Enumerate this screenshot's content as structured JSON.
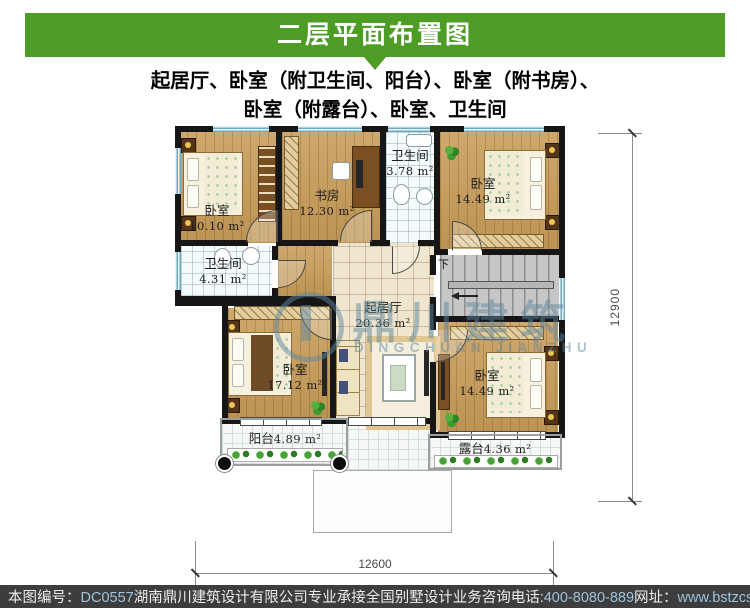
{
  "header": {
    "title": "二层平面布置图"
  },
  "subtitle": {
    "line1": "起居厅、卧室（附卫生间、阳台）、卧室（附书房）、",
    "line2": "卧室（附露台）、卧室、卫生间"
  },
  "rooms": [
    {
      "name": "卧室",
      "area": "10.10 m²"
    },
    {
      "name": "书房",
      "area": "12.30 m²"
    },
    {
      "name": "卫生间",
      "area": "3.78 m²"
    },
    {
      "name": "卧室",
      "area": "14.49 m²"
    },
    {
      "name": "卫生间",
      "area": "4.31 m²"
    },
    {
      "name": "起居厅",
      "area": "20.36 m²"
    },
    {
      "name": "卧室",
      "area": "17.12 m²"
    },
    {
      "name": "卧室",
      "area": "14.49 m²"
    },
    {
      "name": "阳台",
      "area": "4.89 m²"
    },
    {
      "name": "露台",
      "area": "4.36 m²"
    }
  ],
  "stairs": {
    "down_label": "下"
  },
  "dimensions": {
    "right": "12900",
    "bottom": "12600"
  },
  "watermark": {
    "cn": "鼎川建筑",
    "en": "DINGCHUAN JIANZHU"
  },
  "footer": {
    "no_label": "本图编号：",
    "no_value": "DC0557",
    "company": "湖南鼎川建筑设计有限公司专业承接全国别墅设计业务",
    "tel_label": "咨询电话:",
    "tel_value": "400-8080-889",
    "web_label": "网址：",
    "web_value": "www.bstzcs.com"
  },
  "colors": {
    "header_green": "#4c9c26",
    "footer_bg": "#3d3d3d",
    "footer_accent": "#9fc3dc"
  }
}
